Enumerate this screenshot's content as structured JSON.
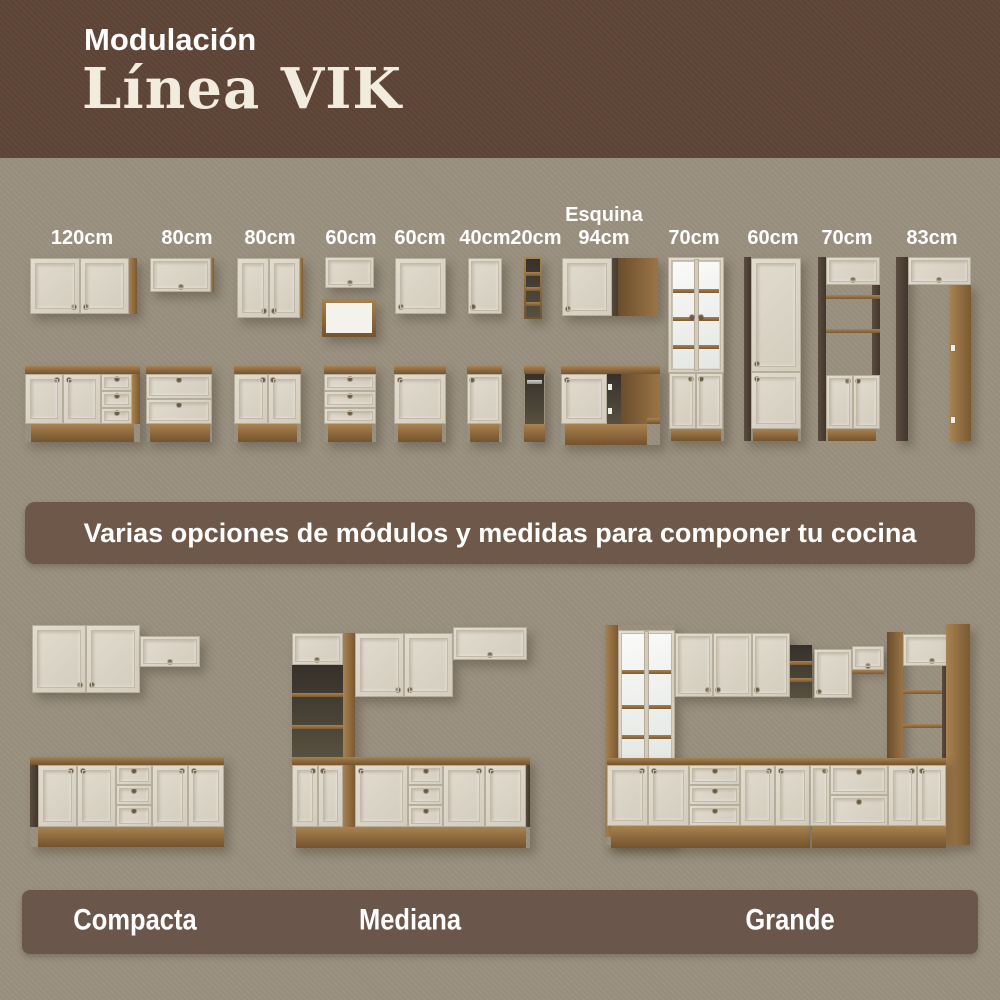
{
  "header": {
    "kicker": "Modulación",
    "title": "Línea VIK"
  },
  "modules": {
    "items": [
      {
        "top": "",
        "size": "120cm"
      },
      {
        "top": "",
        "size": "80cm"
      },
      {
        "top": "",
        "size": "80cm"
      },
      {
        "top": "",
        "size": "60cm"
      },
      {
        "top": "",
        "size": "60cm"
      },
      {
        "top": "",
        "size": "40cm"
      },
      {
        "top": "",
        "size": "20cm"
      },
      {
        "top": "Esquina",
        "size": "94cm"
      },
      {
        "top": "",
        "size": "70cm"
      },
      {
        "top": "",
        "size": "60cm"
      },
      {
        "top": "",
        "size": "70cm"
      },
      {
        "top": "",
        "size": "83cm"
      }
    ]
  },
  "banner": {
    "text": "Varias opciones de módulos y medidas para componer tu cocina"
  },
  "kitchens": {
    "items": [
      {
        "label": "Compacta"
      },
      {
        "label": "Mediana"
      },
      {
        "label": "Grande"
      }
    ]
  },
  "colors": {
    "page_bg": "#99907f",
    "header_bg": "#5e4537",
    "banner_bg": "#6d5849",
    "bar_bg": "#6a564a",
    "cabinet_front": "#d9d2c3",
    "wood": "#8b673c",
    "text_white": "#ffffff",
    "title_cream": "#f2ecdf"
  }
}
